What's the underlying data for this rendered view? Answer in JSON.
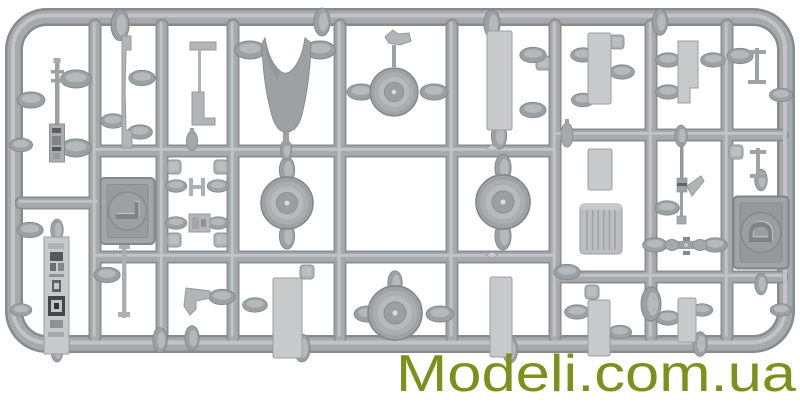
{
  "meta": {
    "description": "Photograph of a light-gray injection-molded plastic model kit sprue (parts frame) on a white background. The sprue holds small scale-model parts: four round road wheels, rectangular hull/fuselage panels, a V-notched fuselage deck, two machine guns, a ribbed seat, a detailed instrument panel, struts and axle pieces. Square tags embossed with sprue letters are molded into the frame, and a website watermark is printed across the lower right of the photo.",
    "visible_parts": [
      "road wheel x4",
      "V-notched fuselage deck",
      "machine gun x2",
      "ribbed seat",
      "instrument panel",
      "rectangular panels",
      "struts and brackets",
      "axle piece",
      "sprue letter tag L",
      "sprue letter tag D"
    ]
  },
  "sprue": {
    "plastic_color": "#a6a9ac",
    "plastic_highlight": "#c5c7c9",
    "plastic_shadow": "#84888c",
    "tag_left": {
      "letter": "L"
    },
    "tag_right": {
      "letter": "D"
    }
  },
  "watermark": {
    "text": "Modeli.com.ua",
    "color": "#7d901c"
  },
  "background_color": "#ffffff"
}
